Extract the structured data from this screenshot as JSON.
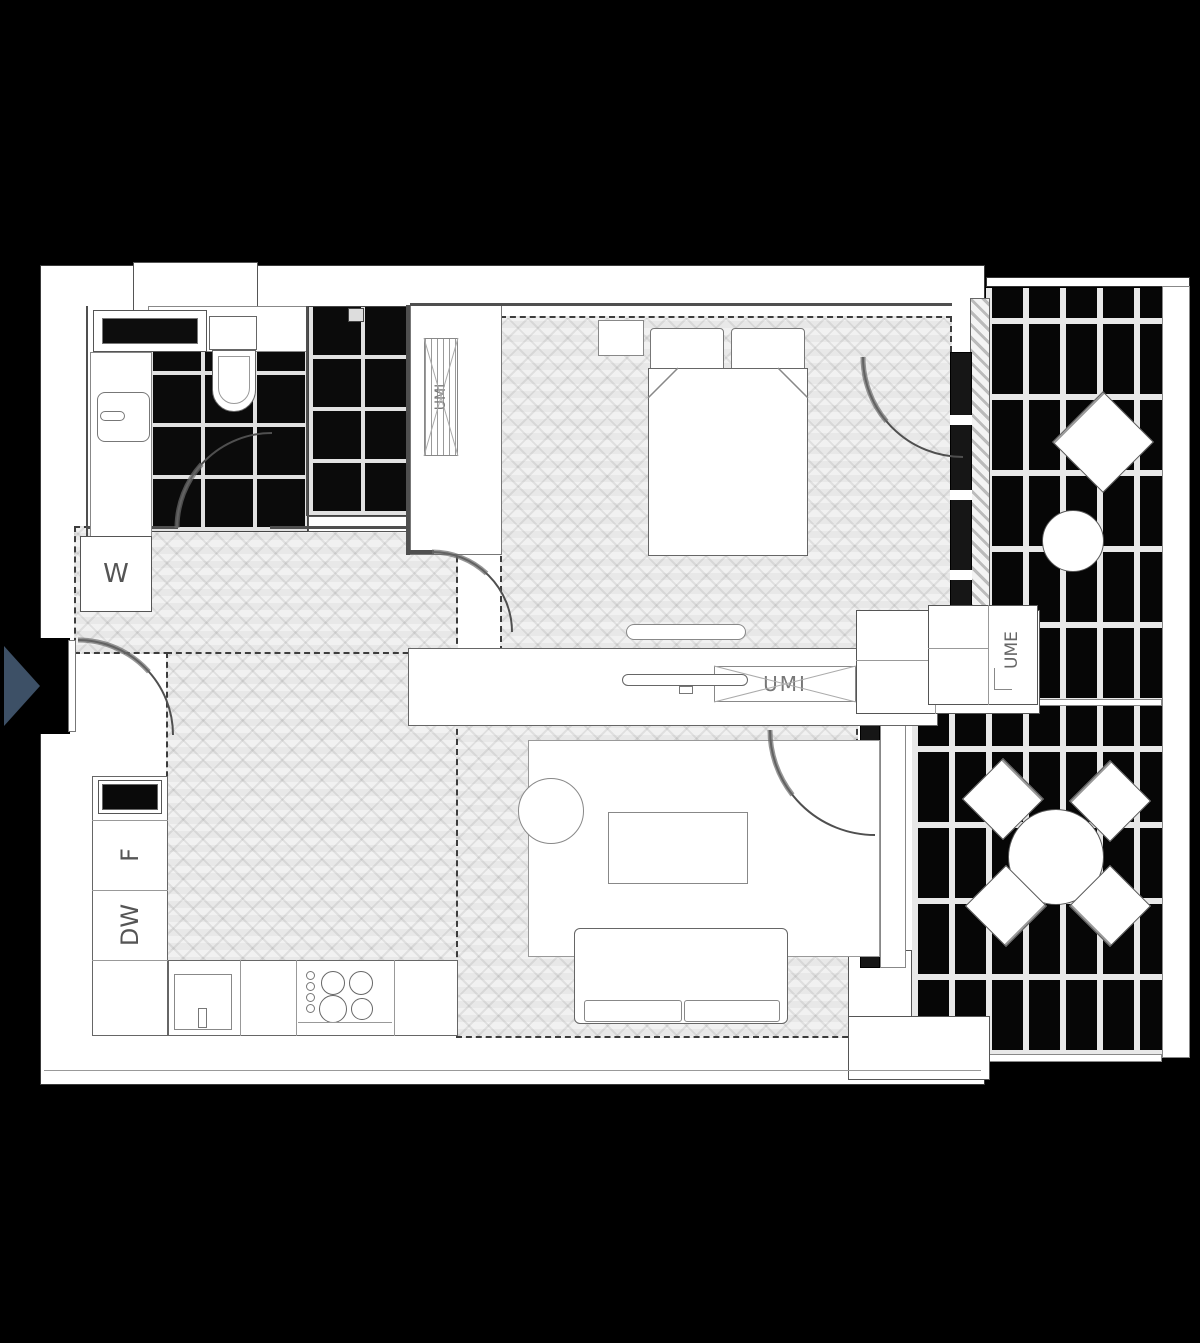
{
  "plan": {
    "labels": {
      "washer": "W",
      "fridge": "F",
      "dishwasher": "DW",
      "wardrobe_bedroom": "UMI",
      "media_unit": "UMI",
      "terrace_unit": "UME"
    },
    "colors": {
      "background": "#000000",
      "entry_arrow": "#3d5066",
      "tile_dark": "#0b0b0b"
    }
  }
}
